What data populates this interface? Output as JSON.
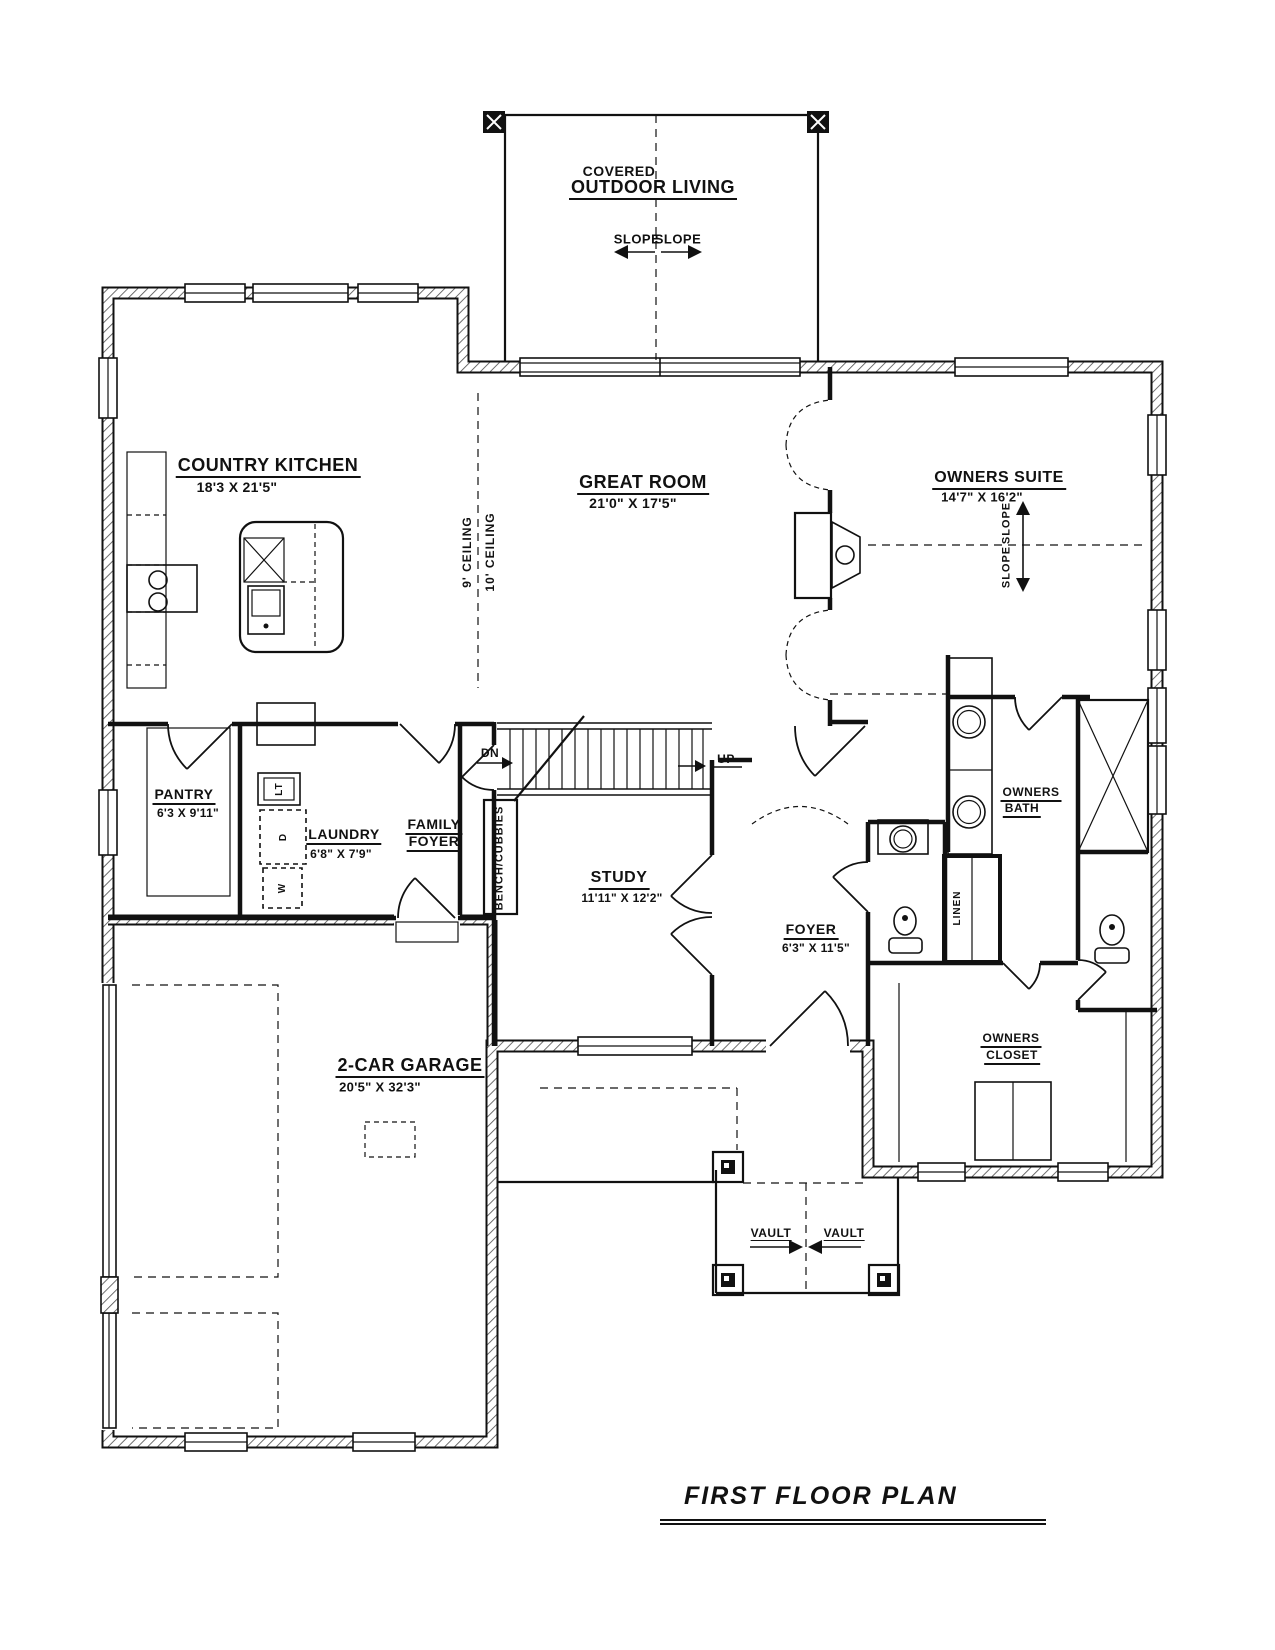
{
  "sheet": {
    "title": "FIRST FLOOR PLAN"
  },
  "rooms": {
    "outdoor_living": {
      "line1": "COVERED",
      "line2": "OUTDOOR LIVING"
    },
    "kitchen": {
      "name": "COUNTRY KITCHEN",
      "dims": "18'3 X 21'5\""
    },
    "great_room": {
      "name": "GREAT ROOM",
      "dims": "21'0\" X 17'5\""
    },
    "owners_suite": {
      "name": "OWNERS SUITE",
      "dims": "14'7\" X 16'2\""
    },
    "pantry": {
      "name": "PANTRY",
      "dims": "6'3 X 9'11\""
    },
    "laundry": {
      "name": "LAUNDRY",
      "dims": "6'8\" X 7'9\""
    },
    "family_foyer": {
      "line1": "FAMILY",
      "line2": "FOYER"
    },
    "study": {
      "name": "STUDY",
      "dims": "11'11\" X 12'2\""
    },
    "foyer": {
      "name": "FOYER",
      "dims": "6'3\" X 11'5\""
    },
    "owners_bath": {
      "line1": "OWNERS",
      "line2": "BATH"
    },
    "owners_closet": {
      "line1": "OWNERS",
      "line2": "CLOSET"
    },
    "garage": {
      "name": "2-CAR GARAGE",
      "dims": "20'5\" X 32'3\""
    }
  },
  "annotations": {
    "slope_left": "SLOPE",
    "slope_right": "SLOPE",
    "slope_up": "SLOPE",
    "slope_down": "SLOPE",
    "ceiling_9": "9' CEILING",
    "ceiling_10": "10' CEILING",
    "bench_cubbies": "BENCH/CUBBIES",
    "linen": "LINEN",
    "dn": "DN",
    "up": "UP",
    "vault_left": "VAULT",
    "vault_right": "VAULT",
    "laundry_tub": "LT",
    "dryer": "D",
    "washer": "W"
  },
  "colors": {
    "ink": "#111111",
    "paper": "#ffffff"
  }
}
